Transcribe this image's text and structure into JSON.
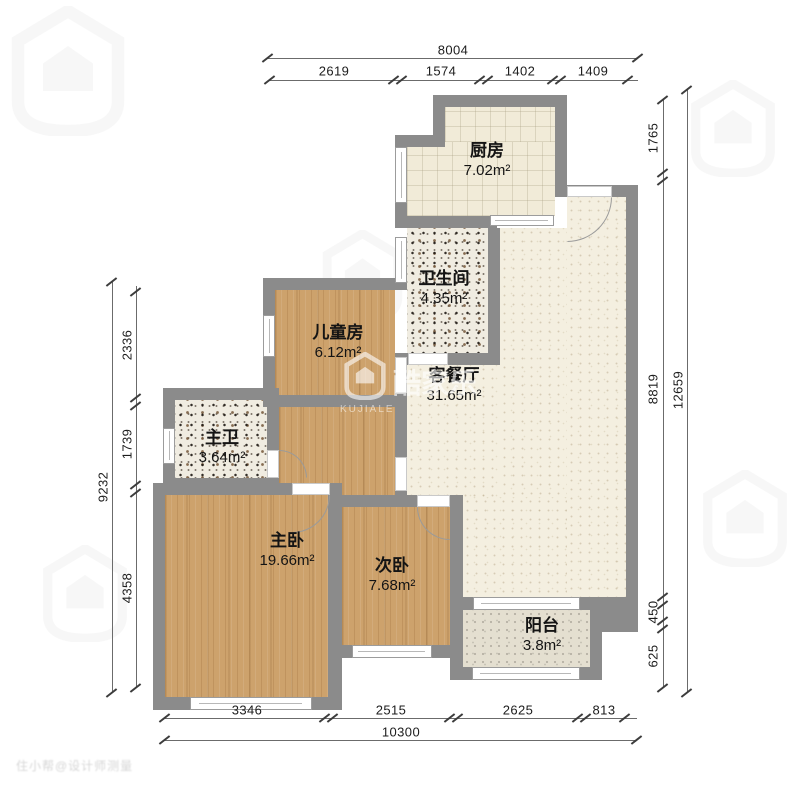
{
  "rooms": [
    {
      "name": "厨房",
      "area": "7.02m²"
    },
    {
      "name": "卫生间",
      "area": "4.35m²"
    },
    {
      "name": "儿童房",
      "area": "6.12m²"
    },
    {
      "name": "客餐厅",
      "area": "31.65m²"
    },
    {
      "name": "主卫",
      "area": "3.64m²"
    },
    {
      "name": "主卧",
      "area": "19.66m²"
    },
    {
      "name": "次卧",
      "area": "7.68m²"
    },
    {
      "name": "阳台",
      "area": "3.8m²"
    }
  ],
  "dimensions": {
    "top": {
      "total": "8004",
      "segments": [
        "2619",
        "1574",
        "1402",
        "1409"
      ]
    },
    "bottom": {
      "total": "10300",
      "segments": [
        "3346",
        "2515",
        "2625",
        "813"
      ]
    },
    "left": {
      "total": "9232",
      "segments": [
        "2336",
        "1739",
        "4358"
      ]
    },
    "right": {
      "total": "12659",
      "segments": [
        "1765",
        "8819",
        "450",
        "625"
      ]
    }
  },
  "watermark": {
    "brand": "酷家乐",
    "latin": "KUJIALE",
    "corner_text": "住小帮@设计师测量"
  },
  "colors": {
    "wall": "#8b8b8b",
    "wood_floor": "#cda26c",
    "cream_floor": "#f1ebd8",
    "living_floor": "#f4efe0",
    "balcony_floor": "#e4dfd0"
  }
}
